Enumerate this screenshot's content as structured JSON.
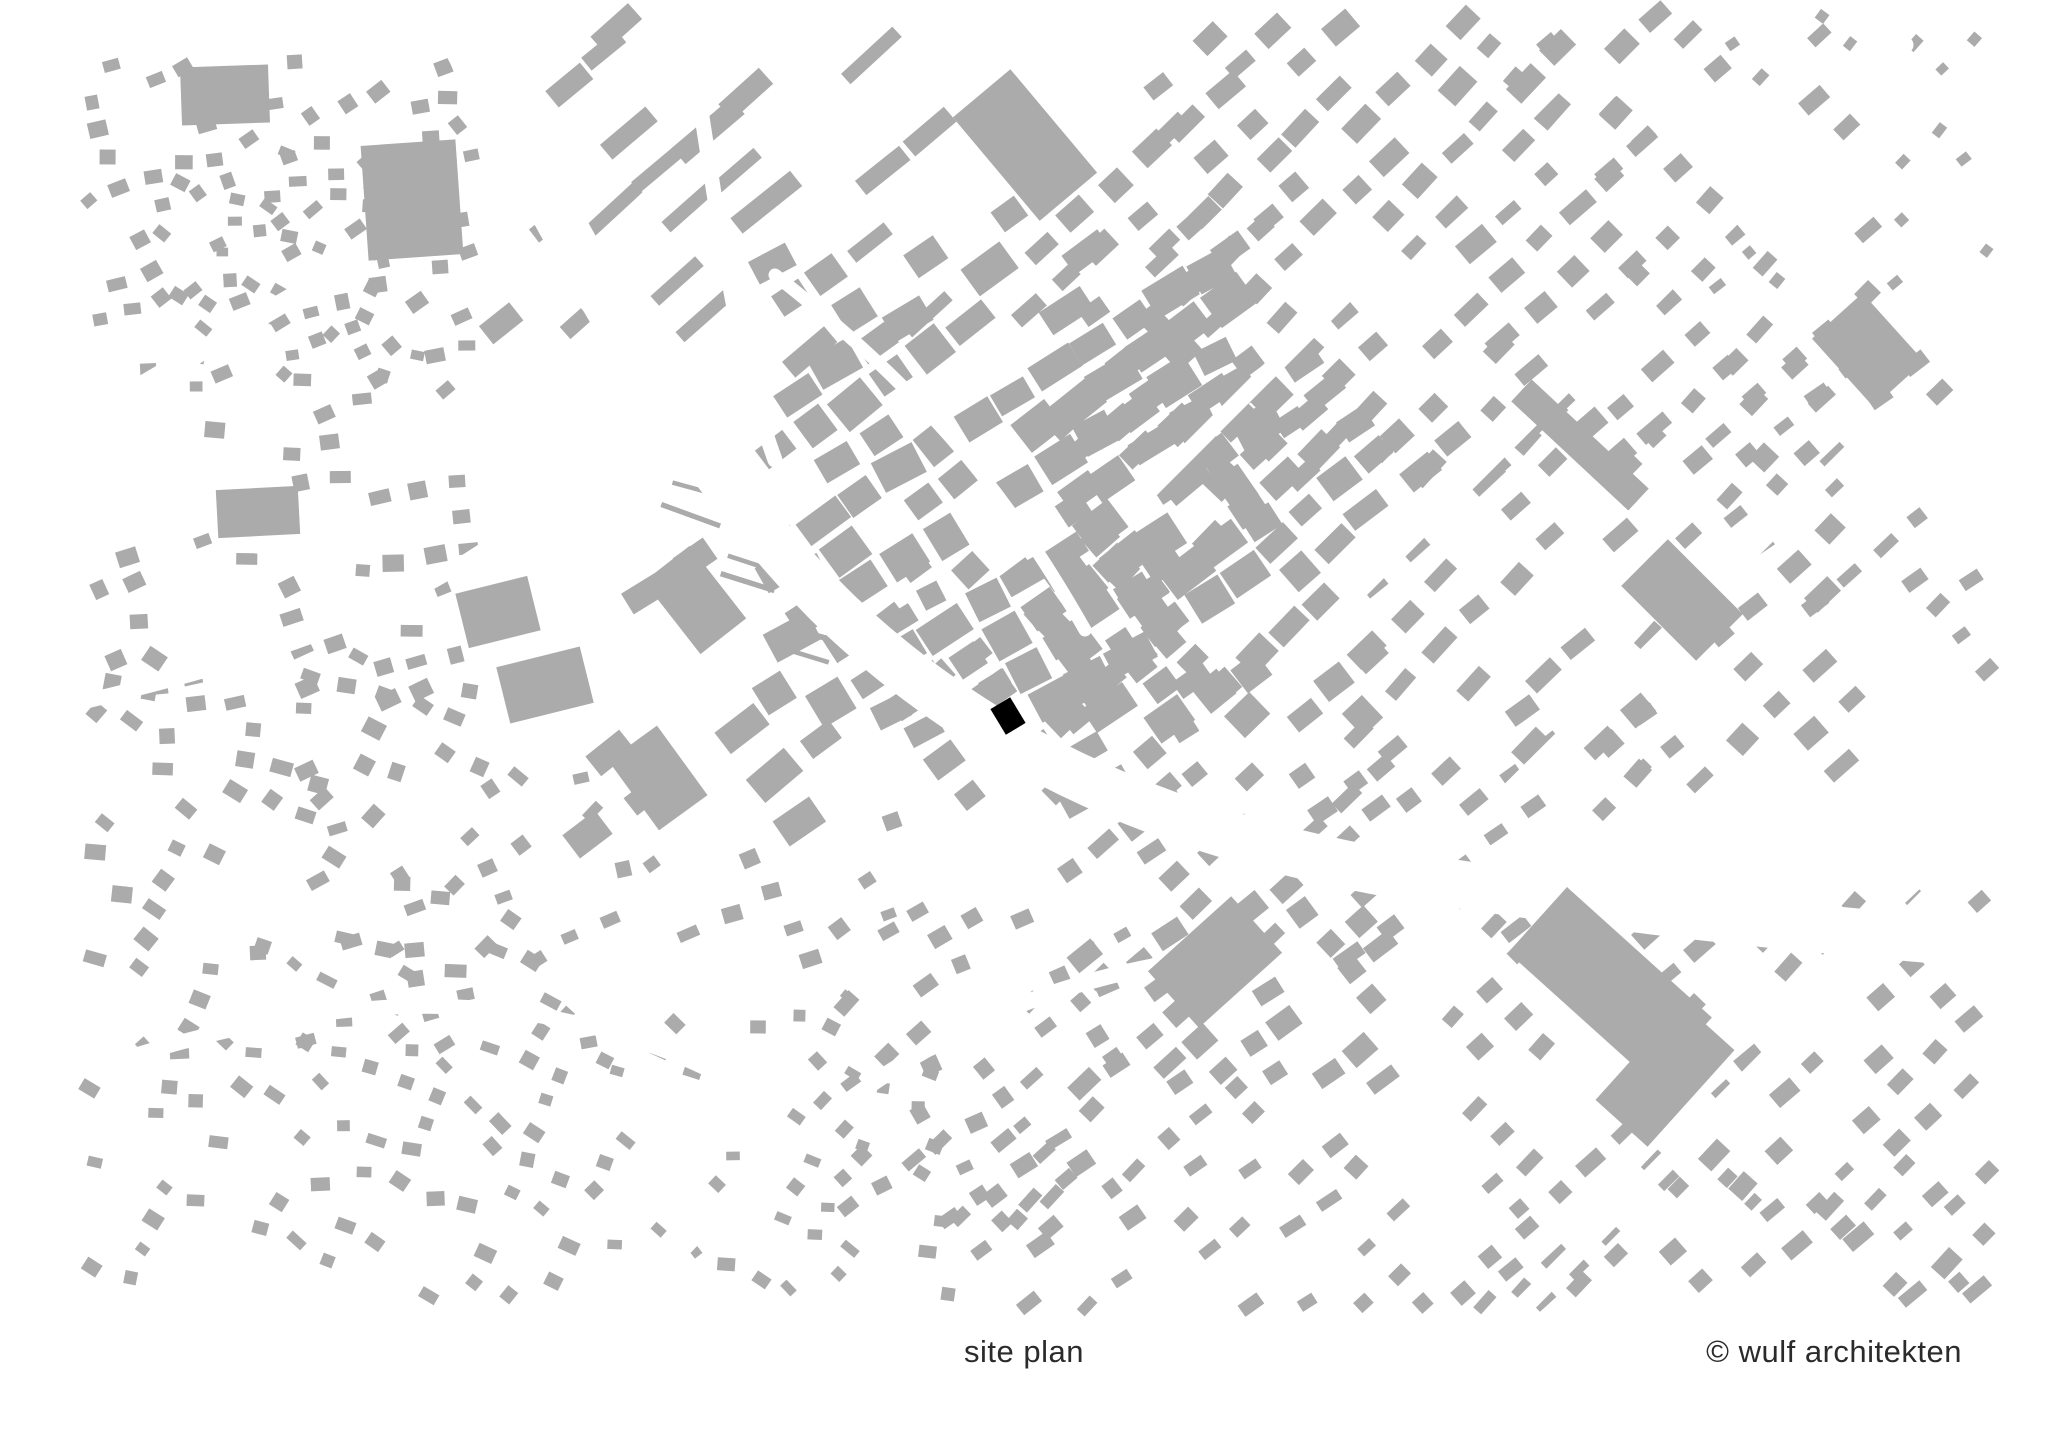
{
  "page": {
    "width": 2048,
    "height": 1448,
    "background": "#ffffff"
  },
  "footer": {
    "caption": "site plan",
    "credit": "© wulf architekten",
    "text_color": "#2b2b2b"
  },
  "map": {
    "description": "figure-ground site plan, grey building footprints on white, black marked project site",
    "building_color": "#ababab",
    "site_color": "#000000",
    "road_color": "#ffffff",
    "site": {
      "cx": 1008,
      "cy": 716,
      "w": 23,
      "h": 30,
      "r": -31
    },
    "clusters": [
      {
        "name": "top-left-outer",
        "x": 85,
        "y": 60,
        "w": 390,
        "h": 330,
        "angle": -20,
        "cell": [
          34,
          30
        ],
        "size": [
          16,
          13
        ],
        "density": 0.55,
        "angleVar": 45,
        "sizeVar": 0.45,
        "seed": 11
      },
      {
        "name": "top-left-inner",
        "x": 150,
        "y": 150,
        "w": 270,
        "h": 230,
        "angle": 15,
        "cell": [
          31,
          27
        ],
        "size": [
          14,
          11
        ],
        "density": 0.45,
        "angleVar": 60,
        "sizeVar": 0.4,
        "seed": 22
      },
      {
        "name": "west-upper",
        "x": 90,
        "y": 395,
        "w": 380,
        "h": 320,
        "angle": -12,
        "cell": [
          37,
          33
        ],
        "size": [
          18,
          14
        ],
        "density": 0.5,
        "angleVar": 35,
        "sizeVar": 0.45,
        "seed": 33
      },
      {
        "name": "west-lower",
        "x": 90,
        "y": 655,
        "w": 430,
        "h": 320,
        "angle": 18,
        "cell": [
          38,
          34
        ],
        "size": [
          18,
          14
        ],
        "density": 0.45,
        "angleVar": 45,
        "sizeVar": 0.45,
        "seed": 44
      },
      {
        "name": "southwest",
        "x": 80,
        "y": 950,
        "w": 530,
        "h": 350,
        "angle": 22,
        "cell": [
          36,
          32
        ],
        "size": [
          16,
          12
        ],
        "density": 0.5,
        "angleVar": 55,
        "sizeVar": 0.45,
        "seed": 55
      },
      {
        "name": "west-central",
        "x": 290,
        "y": 770,
        "w": 360,
        "h": 290,
        "angle": -28,
        "cell": [
          40,
          34
        ],
        "size": [
          17,
          13
        ],
        "density": 0.45,
        "angleVar": 45,
        "sizeVar": 0.45,
        "seed": 66
      },
      {
        "name": "north-slabs-small",
        "x": 420,
        "y": 25,
        "w": 200,
        "h": 320,
        "angle": -40,
        "cell": [
          50,
          48
        ],
        "size": [
          36,
          19
        ],
        "density": 0.4,
        "angleVar": 7,
        "sizeVar": 0.5,
        "seed": 77
      },
      {
        "name": "north-slabs-long",
        "x": 600,
        "y": 25,
        "w": 330,
        "h": 360,
        "angle": -40,
        "cell": [
          58,
          47
        ],
        "size": [
          62,
          17
        ],
        "density": 0.45,
        "angleVar": 6,
        "sizeVar": 0.55,
        "seed": 88
      },
      {
        "name": "orchard-strips",
        "x": 690,
        "y": 455,
        "w": 130,
        "h": 215,
        "angle": -72,
        "cell": [
          24,
          75
        ],
        "size": [
          5,
          58
        ],
        "density": 0.55,
        "angleVar": 6,
        "sizeVar": 0.3,
        "seed": 99
      },
      {
        "name": "old-town-west",
        "x": 770,
        "y": 250,
        "w": 500,
        "h": 470,
        "angle": -33,
        "cell": [
          46,
          40
        ],
        "size": [
          40,
          30
        ],
        "density": 0.78,
        "angleVar": 14,
        "sizeVar": 0.5,
        "seed": 101
      },
      {
        "name": "old-town-east",
        "x": 1050,
        "y": 350,
        "w": 330,
        "h": 380,
        "angle": -40,
        "cell": [
          45,
          38
        ],
        "size": [
          34,
          25
        ],
        "density": 0.7,
        "angleVar": 14,
        "sizeVar": 0.5,
        "seed": 102
      },
      {
        "name": "old-town-south",
        "x": 900,
        "y": 560,
        "w": 300,
        "h": 260,
        "angle": -35,
        "cell": [
          42,
          36
        ],
        "size": [
          30,
          22
        ],
        "density": 0.6,
        "angleVar": 16,
        "sizeVar": 0.5,
        "seed": 103
      },
      {
        "name": "station-quarter",
        "x": 1000,
        "y": 70,
        "w": 280,
        "h": 290,
        "angle": -40,
        "cell": [
          48,
          42
        ],
        "size": [
          30,
          20
        ],
        "density": 0.55,
        "angleVar": 10,
        "sizeVar": 0.5,
        "seed": 104
      },
      {
        "name": "northeast-a",
        "x": 1150,
        "y": 15,
        "w": 530,
        "h": 465,
        "angle": -44,
        "cell": [
          48,
          42
        ],
        "size": [
          29,
          19
        ],
        "density": 0.6,
        "angleVar": 9,
        "sizeVar": 0.5,
        "seed": 105
      },
      {
        "name": "northeast-b",
        "x": 1460,
        "y": 15,
        "w": 420,
        "h": 445,
        "angle": -44,
        "cell": [
          50,
          44
        ],
        "size": [
          23,
          15
        ],
        "density": 0.5,
        "angleVar": 10,
        "sizeVar": 0.5,
        "seed": 106
      },
      {
        "name": "far-northeast",
        "x": 1700,
        "y": 15,
        "w": 290,
        "h": 295,
        "angle": -44,
        "cell": [
          44,
          40
        ],
        "size": [
          13,
          10
        ],
        "density": 0.45,
        "angleVar": 22,
        "sizeVar": 0.4,
        "seed": 107
      },
      {
        "name": "east-central",
        "x": 1360,
        "y": 430,
        "w": 510,
        "h": 350,
        "angle": -44,
        "cell": [
          52,
          46
        ],
        "size": [
          29,
          19
        ],
        "density": 0.55,
        "angleVar": 11,
        "sizeVar": 0.55,
        "seed": 108
      },
      {
        "name": "far-east",
        "x": 1730,
        "y": 310,
        "w": 260,
        "h": 410,
        "angle": -40,
        "cell": [
          46,
          40
        ],
        "size": [
          21,
          14
        ],
        "density": 0.5,
        "angleVar": 16,
        "sizeVar": 0.5,
        "seed": 109
      },
      {
        "name": "east-lower",
        "x": 1300,
        "y": 710,
        "w": 400,
        "h": 250,
        "angle": -40,
        "cell": [
          48,
          42
        ],
        "size": [
          25,
          16
        ],
        "density": 0.5,
        "angleVar": 12,
        "sizeVar": 0.5,
        "seed": 110
      },
      {
        "name": "southeast-a",
        "x": 1450,
        "y": 890,
        "w": 540,
        "h": 410,
        "angle": -44,
        "cell": [
          46,
          40
        ],
        "size": [
          23,
          15
        ],
        "density": 0.55,
        "angleVar": 9,
        "sizeVar": 0.5,
        "seed": 111
      },
      {
        "name": "southeast-b",
        "x": 1340,
        "y": 1160,
        "w": 650,
        "h": 150,
        "angle": -44,
        "cell": [
          44,
          40
        ],
        "size": [
          19,
          13
        ],
        "density": 0.5,
        "angleVar": 10,
        "sizeVar": 0.45,
        "seed": 112
      },
      {
        "name": "south-dense",
        "x": 1050,
        "y": 770,
        "w": 340,
        "h": 330,
        "angle": -38,
        "cell": [
          40,
          36
        ],
        "size": [
          25,
          19
        ],
        "density": 0.65,
        "angleVar": 13,
        "sizeVar": 0.5,
        "seed": 113
      },
      {
        "name": "south-central",
        "x": 820,
        "y": 910,
        "w": 330,
        "h": 320,
        "angle": -35,
        "cell": [
          38,
          34
        ],
        "size": [
          19,
          14
        ],
        "density": 0.55,
        "angleVar": 28,
        "sizeVar": 0.5,
        "seed": 114
      },
      {
        "name": "south-suburb",
        "x": 610,
        "y": 990,
        "w": 340,
        "h": 310,
        "angle": 25,
        "cell": [
          36,
          32
        ],
        "size": [
          15,
          11
        ],
        "density": 0.5,
        "angleVar": 55,
        "sizeVar": 0.45,
        "seed": 115
      },
      {
        "name": "centre-west-slabs",
        "x": 560,
        "y": 520,
        "w": 300,
        "h": 330,
        "angle": -35,
        "cell": [
          62,
          54
        ],
        "size": [
          42,
          25
        ],
        "density": 0.42,
        "angleVar": 12,
        "sizeVar": 0.5,
        "seed": 116
      },
      {
        "name": "south-mid",
        "x": 950,
        "y": 1080,
        "w": 420,
        "h": 230,
        "angle": -40,
        "cell": [
          42,
          36
        ],
        "size": [
          20,
          14
        ],
        "density": 0.5,
        "angleVar": 18,
        "sizeVar": 0.5,
        "seed": 117
      },
      {
        "name": "river-south-scatter",
        "x": 640,
        "y": 800,
        "w": 260,
        "h": 180,
        "angle": -30,
        "cell": [
          46,
          40
        ],
        "size": [
          18,
          13
        ],
        "density": 0.4,
        "angleVar": 30,
        "sizeVar": 0.5,
        "seed": 118
      }
    ],
    "landmarks": [
      {
        "x": 1025,
        "y": 145,
        "w": 75,
        "h": 135,
        "r": -40
      },
      {
        "x": 412,
        "y": 200,
        "w": 95,
        "h": 115,
        "r": -4
      },
      {
        "x": 225,
        "y": 95,
        "w": 88,
        "h": 58,
        "r": -2
      },
      {
        "x": 258,
        "y": 512,
        "w": 82,
        "h": 48,
        "r": -3
      },
      {
        "x": 695,
        "y": 600,
        "w": 58,
        "h": 92,
        "r": -38
      },
      {
        "x": 658,
        "y": 778,
        "w": 60,
        "h": 86,
        "r": -36
      },
      {
        "x": 498,
        "y": 612,
        "w": 74,
        "h": 56,
        "r": -14
      },
      {
        "x": 545,
        "y": 685,
        "w": 86,
        "h": 58,
        "r": -14
      },
      {
        "x": 1868,
        "y": 350,
        "w": 68,
        "h": 92,
        "r": -42
      },
      {
        "x": 1580,
        "y": 445,
        "w": 30,
        "h": 160,
        "r": -47
      },
      {
        "x": 1682,
        "y": 600,
        "w": 66,
        "h": 106,
        "r": -45
      },
      {
        "x": 1610,
        "y": 985,
        "w": 88,
        "h": 195,
        "r": -48
      },
      {
        "x": 1665,
        "y": 1075,
        "w": 130,
        "h": 70,
        "r": -48
      },
      {
        "x": 1215,
        "y": 962,
        "w": 112,
        "h": 76,
        "r": -42
      }
    ],
    "roads": [
      {
        "d": "M 430,-30 C 560,230 680,460 840,615 C 1010,775 1210,845 1430,880 C 1660,915 1860,935 2070,950",
        "w": 48
      },
      {
        "d": "M 50,440 L 560,140",
        "w": 20
      },
      {
        "d": "M 70,705 C 280,655 420,610 550,500",
        "w": 15
      },
      {
        "d": "M 90,1070 C 340,985 530,985 710,1070",
        "w": 15
      },
      {
        "d": "M 775,275 C 915,385 1000,480 1085,630",
        "w": 13
      },
      {
        "d": "M 1140,500 L 1720,-80",
        "w": 17
      },
      {
        "d": "M 1290,660 L 1905,45",
        "w": 17
      },
      {
        "d": "M 1445,855 L 2075,230",
        "w": 17
      },
      {
        "d": "M 1460,1370 L 2080,745",
        "w": 20
      },
      {
        "d": "M 610,1330 C 800,1110 950,1005 1160,965",
        "w": 16
      },
      {
        "d": "M 690,40 C 720,230 735,350 775,460",
        "w": 15
      }
    ]
  }
}
